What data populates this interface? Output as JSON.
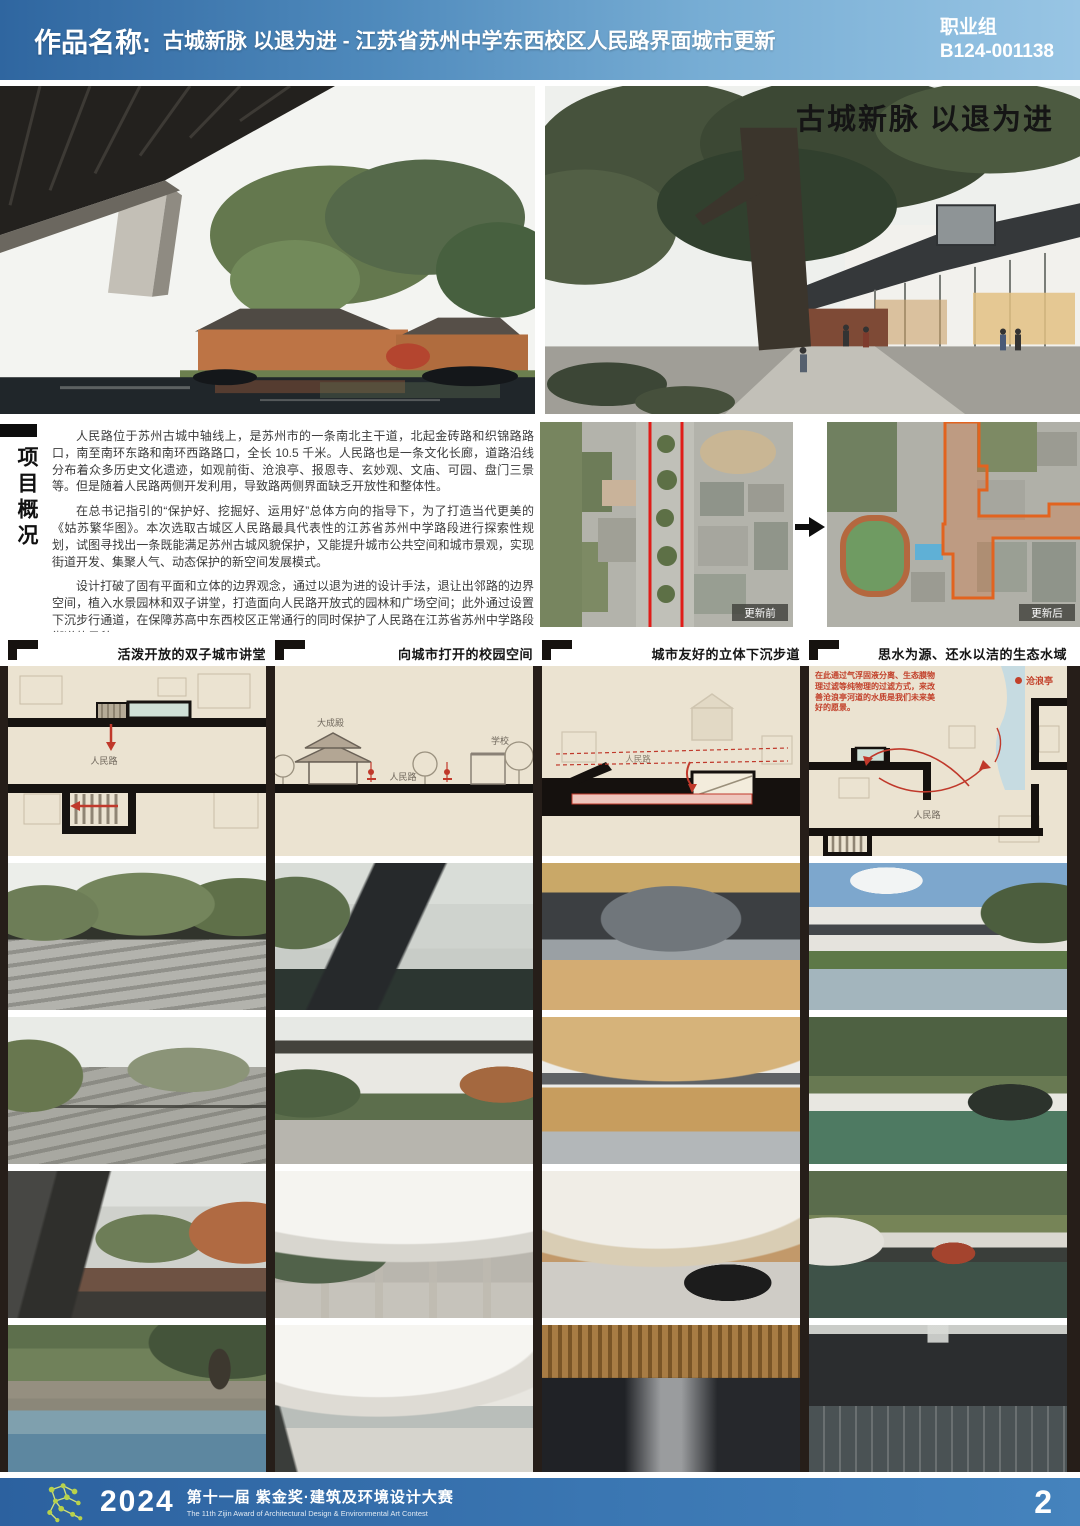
{
  "header": {
    "label": "作品名称:",
    "title": "古城新脉 以退为进 - 江苏省苏州中学东西校区人民路界面城市更新",
    "group": "职业组",
    "entry_no": "B124-001138",
    "accent_color": "#2f66a0"
  },
  "hero": {
    "right_title": "古城新脉 以退为进"
  },
  "overview": {
    "section_title": "项目概况",
    "paragraphs": [
      "人民路位于苏州古城中轴线上，是苏州市的一条南北主干道，北起金砖路和织锦路路口，南至南环东路和南环西路路口，全长 10.5 千米。人民路也是一条文化长廊，道路沿线分布着众多历史文化遗迹，如观前街、沧浪亭、报恩寺、玄妙观、文庙、可园、盘门三景等。但是随着人民路两侧开发利用，导致路两侧界面缺乏开放性和整体性。",
      "在总书记指引的“保护好、挖掘好、运用好”总体方向的指导下，为了打造当代更美的《姑苏繁华图》。本次选取古城区人民路最具代表性的江苏省苏州中学路段进行探索性规划，试图寻找出一条既能满足苏州古城风貌保护，又能提升城市公共空间和城市景观，实现街道开发、集聚人气、动态保护的新空间发展模式。",
      "设计打破了固有平面和立体的边界观念，通过以退为进的设计手法，退让出邻路的边界空间，植入水景园林和双子讲堂，打造面向人民路开放式的园林和广场空间；此外通过设置下沉步行通道，在保障苏高中东西校区正常通行的同时保护了人民路在江苏省苏州中学路段街道的风貌。"
    ],
    "maps": {
      "before_label": "更新前",
      "after_label": "更新后",
      "highlight_color": "#e2631f",
      "line_color": "#e01c18"
    }
  },
  "columns": [
    {
      "title": "活泼开放的双子城市讲堂",
      "diagram_labels": {
        "road": "人民路"
      }
    },
    {
      "title": "向城市打开的校园空间",
      "diagram_labels": {
        "hall": "大成殿",
        "school": "学校",
        "road": "人民路"
      }
    },
    {
      "title": "城市友好的立体下沉步道",
      "diagram_labels": {
        "road": "人民路"
      }
    },
    {
      "title": "思水为源、还水以洁的生态水域",
      "diagram_labels": {
        "road": "人民路",
        "pavilion": "沧浪亭",
        "note": "在此通过气浮固液分离、生态膜物理过滤等纯物理的过滤方式，来改善沧浪亭河道的水质是我们未来美好的愿景。"
      }
    }
  ],
  "footer": {
    "year": "2024",
    "title": "第十一届 紫金奖·建筑及环境设计大赛",
    "subtitle": "The 11th Zijin Award of Architectural Design & Environmental Art Contest",
    "page": "2"
  }
}
